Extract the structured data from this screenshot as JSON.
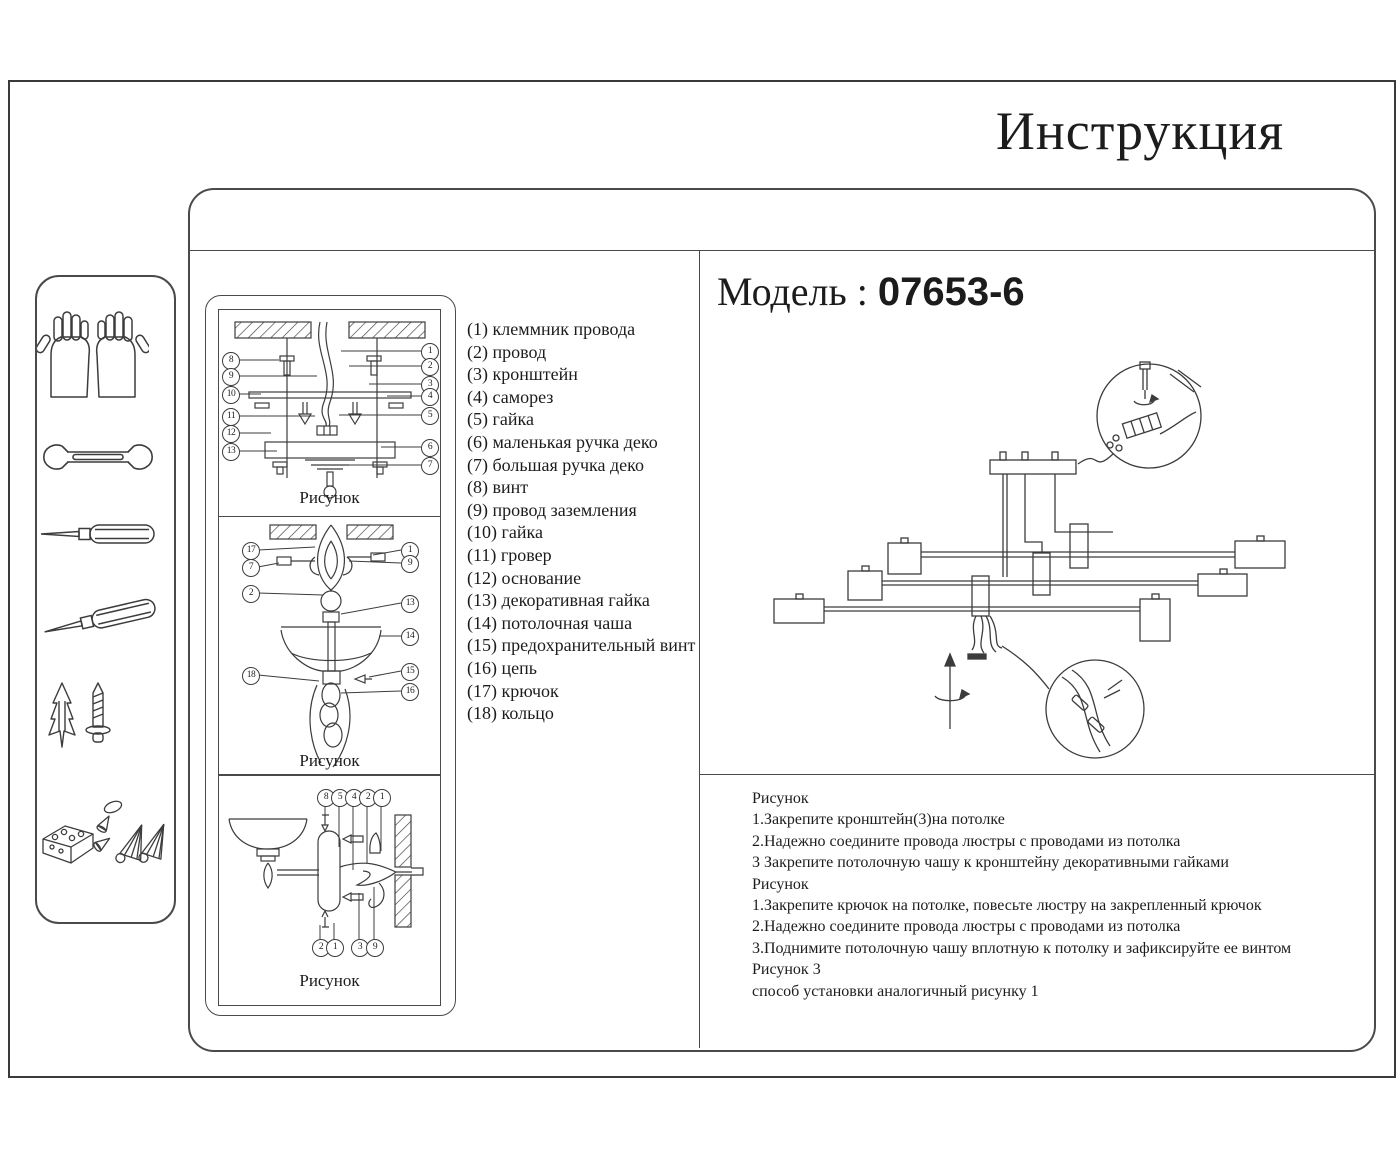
{
  "title": "Инструкция",
  "model": {
    "label": "Модель :",
    "value": "07653-6"
  },
  "sidebar": {
    "icons": [
      "gloves-icon",
      "wrench-icon",
      "screwdriver-icon",
      "screwdriver-angled-icon",
      "anchor-screw-icon",
      "small-parts-icon"
    ]
  },
  "parts": [
    {
      "num": "(1)",
      "name": "клеммник провода"
    },
    {
      "num": "(2)",
      "name": "провод"
    },
    {
      "num": "(3)",
      "name": "кронштейн"
    },
    {
      "num": "(4)",
      "name": "саморез"
    },
    {
      "num": "(5)",
      "name": "гайка"
    },
    {
      "num": "(6)",
      "name": "маленькая ручка деко"
    },
    {
      "num": "(7)",
      "name": "большая ручка деко"
    },
    {
      "num": "(8)",
      "name": "винт"
    },
    {
      "num": "(9)",
      "name": "провод заземления"
    },
    {
      "num": "(10)",
      "name": "гайка"
    },
    {
      "num": "(11)",
      "name": "гровер"
    },
    {
      "num": "(12)",
      "name": "основание"
    },
    {
      "num": "(13)",
      "name": "декоративная гайка"
    },
    {
      "num": "(14)",
      "name": "потолочная чаша"
    },
    {
      "num": "(15)",
      "name": "предохранительный винт"
    },
    {
      "num": "(16)",
      "name": "цепь"
    },
    {
      "num": "(17)",
      "name": "крючок"
    },
    {
      "num": "(18)",
      "name": "кольцо"
    }
  ],
  "figures": [
    {
      "caption": "Рисунок",
      "callouts": [
        {
          "n": "8",
          "x": 11,
          "y": 50
        },
        {
          "n": "9",
          "x": 11,
          "y": 66
        },
        {
          "n": "10",
          "x": 11,
          "y": 84
        },
        {
          "n": "11",
          "x": 11,
          "y": 106
        },
        {
          "n": "12",
          "x": 11,
          "y": 123
        },
        {
          "n": "13",
          "x": 11,
          "y": 141
        },
        {
          "n": "1",
          "x": 210,
          "y": 41
        },
        {
          "n": "2",
          "x": 210,
          "y": 56
        },
        {
          "n": "3",
          "x": 210,
          "y": 74
        },
        {
          "n": "4",
          "x": 210,
          "y": 86
        },
        {
          "n": "5",
          "x": 210,
          "y": 105
        },
        {
          "n": "6",
          "x": 210,
          "y": 137
        },
        {
          "n": "7",
          "x": 210,
          "y": 155
        }
      ]
    },
    {
      "caption": "Рисунок",
      "callouts": [
        {
          "n": "17",
          "x": 31,
          "y": 33
        },
        {
          "n": "7",
          "x": 31,
          "y": 50
        },
        {
          "n": "2",
          "x": 31,
          "y": 76
        },
        {
          "n": "18",
          "x": 31,
          "y": 158
        },
        {
          "n": "1",
          "x": 190,
          "y": 33
        },
        {
          "n": "9",
          "x": 190,
          "y": 46
        },
        {
          "n": "13",
          "x": 190,
          "y": 86
        },
        {
          "n": "14",
          "x": 190,
          "y": 119
        },
        {
          "n": "15",
          "x": 190,
          "y": 154
        },
        {
          "n": "16",
          "x": 190,
          "y": 174
        }
      ]
    },
    {
      "caption": "Рисунок",
      "callouts": [
        {
          "n": "8",
          "x": 106,
          "y": 22
        },
        {
          "n": "5",
          "x": 120,
          "y": 22
        },
        {
          "n": "4",
          "x": 134,
          "y": 22
        },
        {
          "n": "2",
          "x": 148,
          "y": 22
        },
        {
          "n": "1",
          "x": 162,
          "y": 22
        },
        {
          "n": "2",
          "x": 101,
          "y": 172
        },
        {
          "n": "1",
          "x": 115,
          "y": 172
        },
        {
          "n": "3",
          "x": 140,
          "y": 172
        },
        {
          "n": "9",
          "x": 155,
          "y": 172
        }
      ]
    }
  ],
  "instructions": [
    "Рисунок",
    "1.Закрепите кронштейн(3)на потолке",
    "2.Надежно соедините провода люстры с проводами из потолка",
    "3 Закрепите потолочную чашу к кронштейну декоративными гайками",
    "Рисунок",
    "1.Закрепите крючок на потолке, повесьте люстру на закрепленный крючок",
    "2.Надежно соедините провода люстры с проводами из потолка",
    "3.Поднимите потолочную чашу вплотную к потолку и зафиксируйте ее винтом",
    "Рисунок 3",
    "способ установки аналогичный рисунку 1"
  ]
}
